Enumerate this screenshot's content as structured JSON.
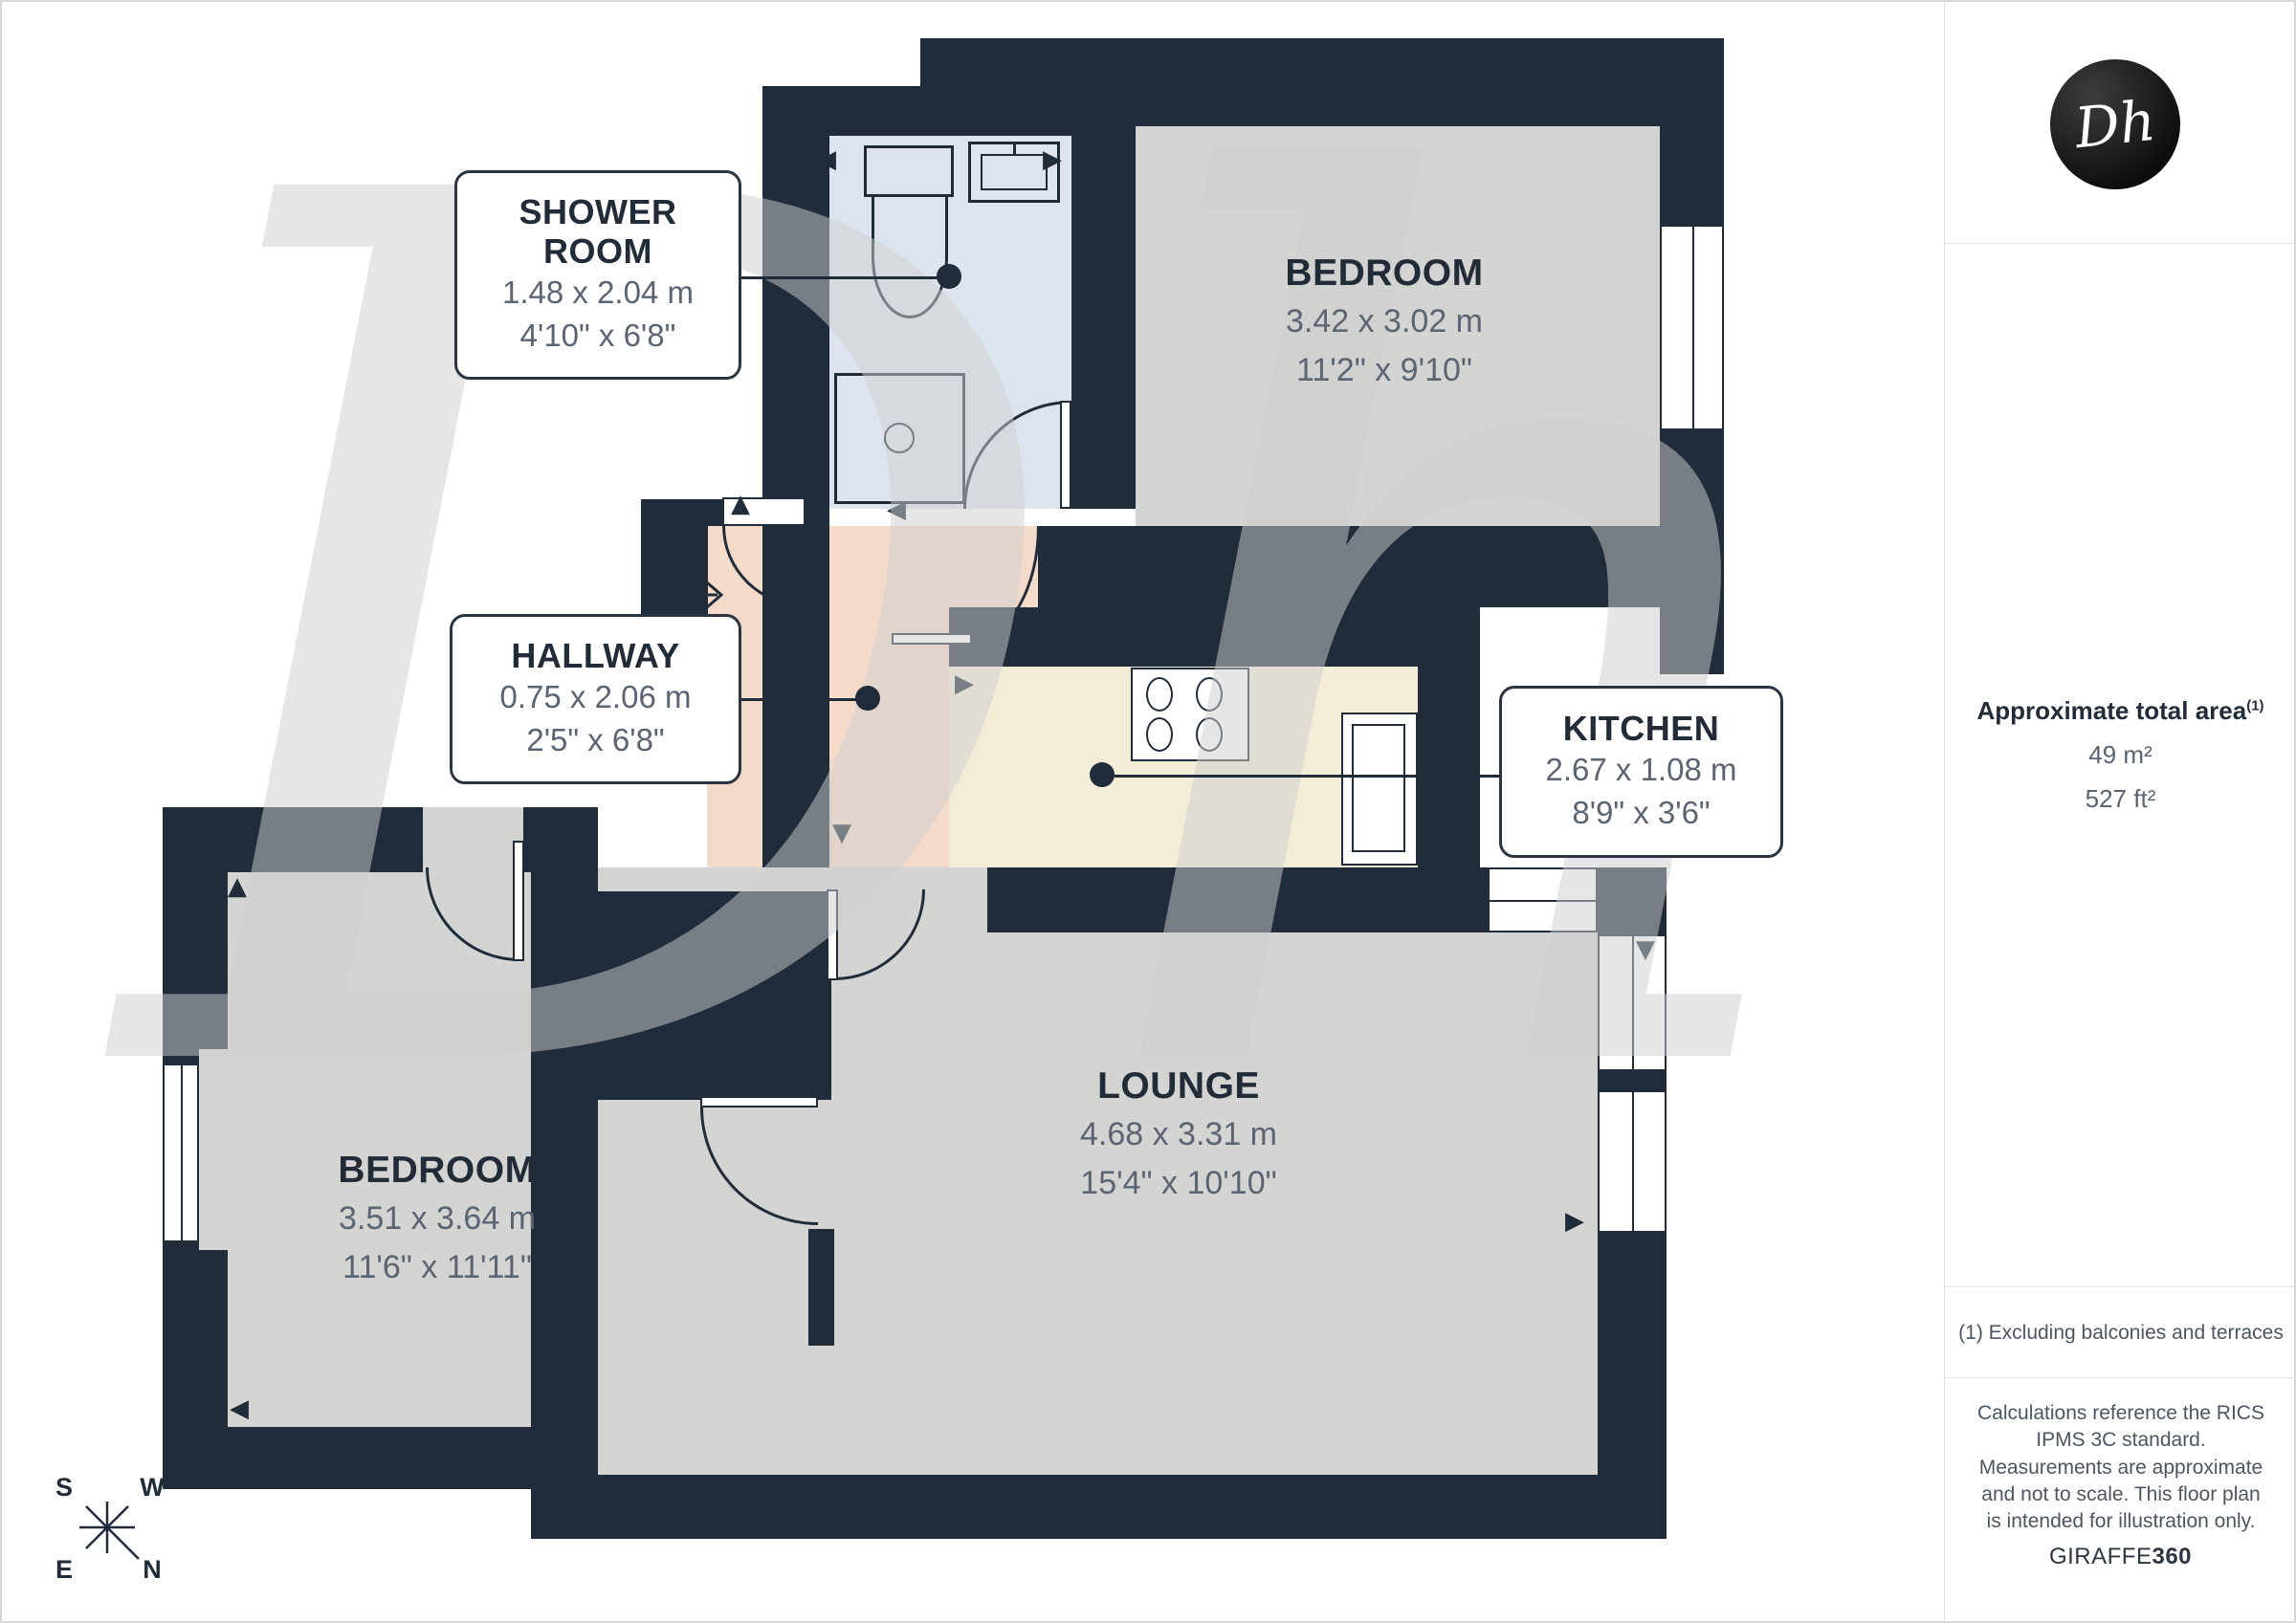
{
  "colors": {
    "wall": "#212c3a",
    "floor": "#d4d4d2",
    "shower_floor": "#dee4ef",
    "hallway_floor": "#f4dac9",
    "kitchen_floor": "#f3edd8",
    "ink": "#222c38",
    "dim": "#5b6472"
  },
  "watermark": {
    "text": "Dh"
  },
  "logo": {
    "text": "Dh"
  },
  "icons": {
    "up": "▲",
    "down": "▼",
    "left": "◀",
    "right": "▶"
  },
  "rooms": [
    {
      "id": "shower-room",
      "name": "SHOWER ROOM",
      "metric": "1.48 x 2.04 m",
      "imperial": "4'10\" x 6'8\""
    },
    {
      "id": "bedroom-top",
      "name": "BEDROOM",
      "metric": "3.42 x 3.02 m",
      "imperial": "11'2\" x 9'10\""
    },
    {
      "id": "hallway",
      "name": "HALLWAY",
      "metric": "0.75 x 2.06 m",
      "imperial": "2'5\" x 6'8\""
    },
    {
      "id": "kitchen",
      "name": "KITCHEN",
      "metric": "2.67 x 1.08 m",
      "imperial": "8'9\" x 3'6\""
    },
    {
      "id": "lounge",
      "name": "LOUNGE",
      "metric": "4.68 x 3.31 m",
      "imperial": "15'4\" x 10'10\""
    },
    {
      "id": "bedroom-left",
      "name": "BEDROOM",
      "metric": "3.51 x 3.64 m",
      "imperial": "11'6\" x 11'11\""
    }
  ],
  "sidebar": {
    "area_title": "Approximate total area",
    "area_sup": "(1)",
    "area_m": "49 m²",
    "area_ft": "527 ft²",
    "footnote": "(1) Excluding balconies and terraces",
    "disclaimer": "Calculations reference the RICS IPMS 3C standard. Measurements are approximate and not to scale. This floor plan is intended for illustration only.",
    "brand_left": "GIRAFFE",
    "brand_right": "360"
  },
  "compass": {
    "top_left": "S",
    "top_right": "W",
    "bottom_left": "E",
    "bottom_right": "N"
  }
}
